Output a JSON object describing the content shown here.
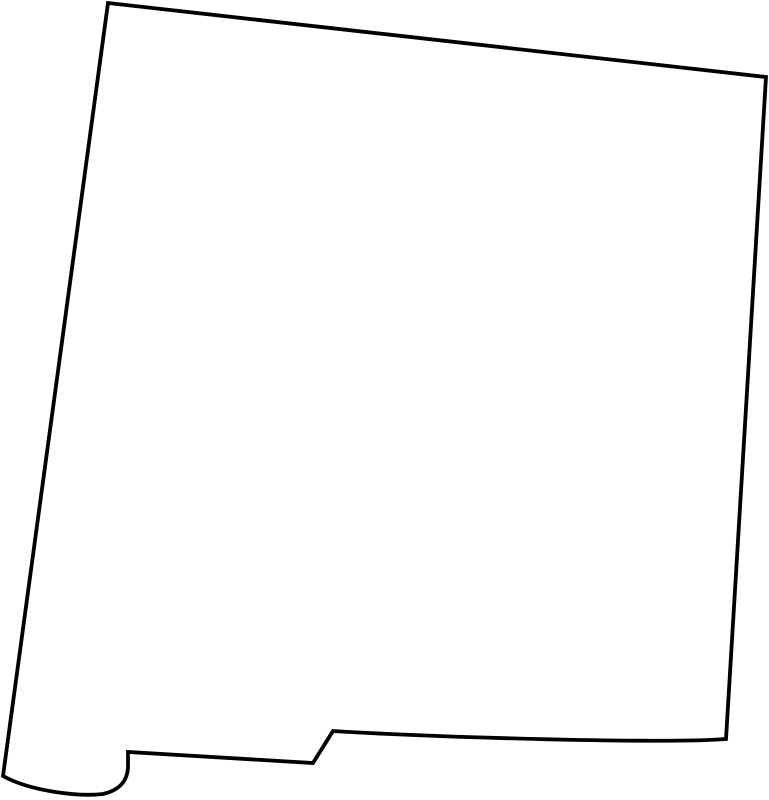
{
  "page": {
    "background_color": "#ffffff",
    "width": 769,
    "height": 800
  },
  "map": {
    "region": "New Mexico",
    "type": "state-outline-map",
    "outline_color": "#000000",
    "fill_color": "#ffffff",
    "stroke_width": "3.8",
    "viewbox": "0 0 769 800",
    "path": "M 108,3 L 766,77 L 726,739 C 660,744 430,737 333,731 L 313,763 L 128,752 L 128,768 C 127,781 120,790 103,794 C 78,797 30,791 3,776 Z"
  }
}
